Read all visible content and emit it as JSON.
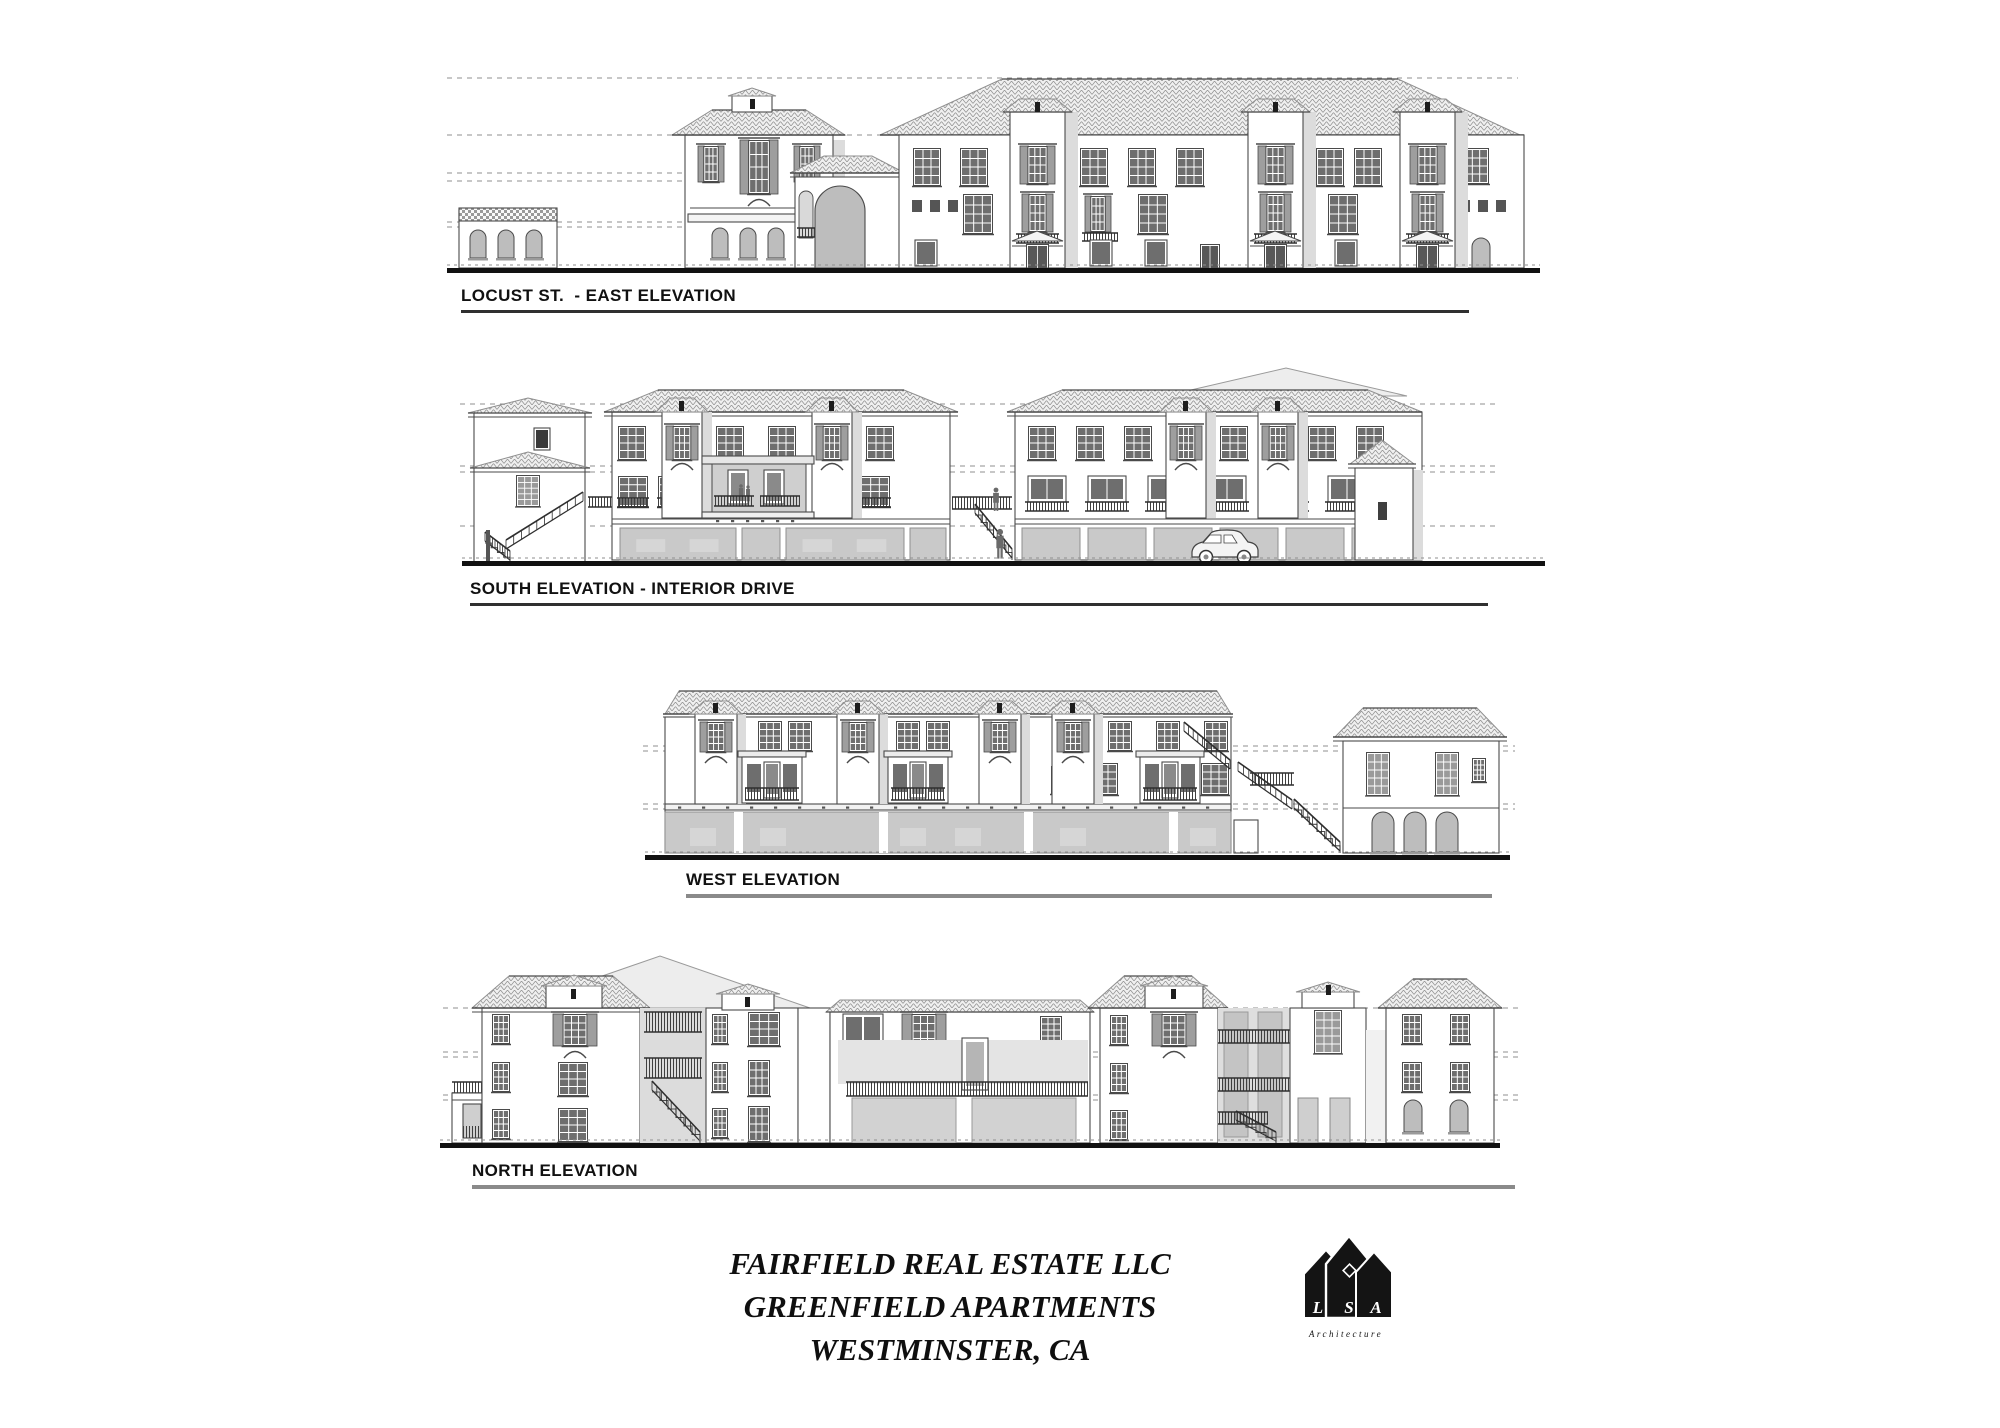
{
  "page": {
    "background": "#ffffff",
    "ink": "#1a1a1a"
  },
  "elevations": [
    {
      "id": "east",
      "label": "LOCUST ST.  - EAST ELEVATION"
    },
    {
      "id": "south",
      "label": "SOUTH ELEVATION - INTERIOR DRIVE"
    },
    {
      "id": "west",
      "label": "WEST ELEVATION"
    },
    {
      "id": "north",
      "label": "NORTH ELEVATION"
    }
  ],
  "title_block": {
    "line1": "FAIRFIELD REAL ESTATE LLC",
    "line2": "GREENFIELD APARTMENTS",
    "line3": "WESTMINSTER, CA"
  },
  "logo": {
    "letters": [
      "L",
      "S",
      "A"
    ],
    "caption": "Architecture"
  },
  "colors": {
    "line": "#4a4a4a",
    "roof_fill": "#f0f0f0",
    "roof_line": "#8f8f8f",
    "glass": "#6e6e6e",
    "shutter": "#9e9e9e",
    "garage": "#c9c9c9",
    "arch": "#bdbdbd",
    "shadow": "#dcdcdc",
    "ground": "#111111",
    "datum": "#8f8f8f"
  }
}
